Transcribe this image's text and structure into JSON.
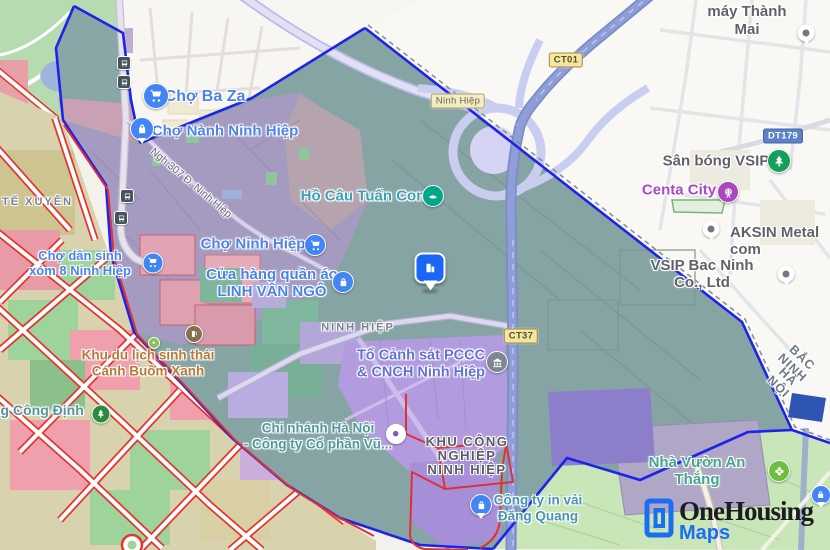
{
  "brand": {
    "name": "OneHousing",
    "sub": "Maps"
  },
  "labels": {
    "cho_ba_za": "Chợ Ba Za",
    "cho_nanh_ninh_hiep": "Chợ Nành Ninh Hiệp",
    "ngo_307": "Ngh.307 Đ. Ninh Hiệp",
    "ho_cau_tuan_con": "Hồ Câu Tuấn Con",
    "cho_ninh_hiep": "Chợ Ninh Hiệp",
    "linh_van_ngo": "Cửa hàng quần áo\nLINH VÂN NGÔ",
    "ninh_hiep_area": "NINH HIỆP",
    "pccc": "Tổ Cảnh sát PCCC\n& CNCH Ninh Hiệp",
    "kcn": "KHU CÔNG\nNGHIỆP\nNINH HIỆP",
    "chi_nhanh": "Chi nhánh Hà Nội\n- Công ty Cổ phần Vũ...",
    "cong_ty_in_vai": "Công ty in vải\nĐăng Quang",
    "sua_xe_thanh_mai": "Sửa xe máy Thành Mai",
    "san_bong_vsip": "Sân bóng VSIP",
    "centa_city": "Centa City",
    "aksin": "AKSIN Metal com",
    "vsip_bac_ninh": "VSIP Bac Ninh Co., Ltd",
    "nha_vuon_an_thang": "Nhà Vườn An Thắng",
    "cho_dan_sinh": "Chợ dân sinh\nxóm 8 Ninh Hiệp",
    "te_xuyen": "TẾ XUYÊN",
    "khu_du_lich": "Khu du lịch sinh thái\nCánh Buồm Xanh",
    "ng_cong_dinh": "ng Công Định",
    "bac_ninh": "BẮC NINH",
    "ha_noi": "HÀ NỘI"
  },
  "shields": {
    "ct01": "CT01",
    "ct37": "CT37",
    "dt179": "DT179",
    "ninh_hiep_road": "Ninh Hiệp"
  },
  "icons": {
    "shopping_cart": "#4285f4",
    "shopping_bag_pin": "#4285f4",
    "fishing": "#01a789",
    "government_building": "#7d8692",
    "tree_park": "#14a05a",
    "attraction_wheel": "#ab47bc",
    "flower_garden": "#6cbf3f",
    "park_dark": "#2e8b3d",
    "generic_place_pin": "#6f7a86",
    "bus_stop": "#44535e",
    "property_pin": "#1a66f6",
    "lock_pin": "#4285f4",
    "business_dot": "#7a5fb5",
    "poi_brown": "#8a6f4e"
  },
  "colors": {
    "boundary_blue": "#1d23ea",
    "boundary_red": "#e03131",
    "region_teal": "#86a4a4",
    "village_purple": "#a59bc0",
    "industrial_purple": "#b29bdf",
    "zoning_green": "#9ed49b",
    "zoning_pink": "#f0a0ac",
    "zoning_road_red": "#e8332e",
    "highway_blue": "#8f9ed8",
    "bottom_green": "#c8e6b8",
    "brand_blue": "#1b6ef3",
    "brand_dark": "#1d1d1f"
  }
}
